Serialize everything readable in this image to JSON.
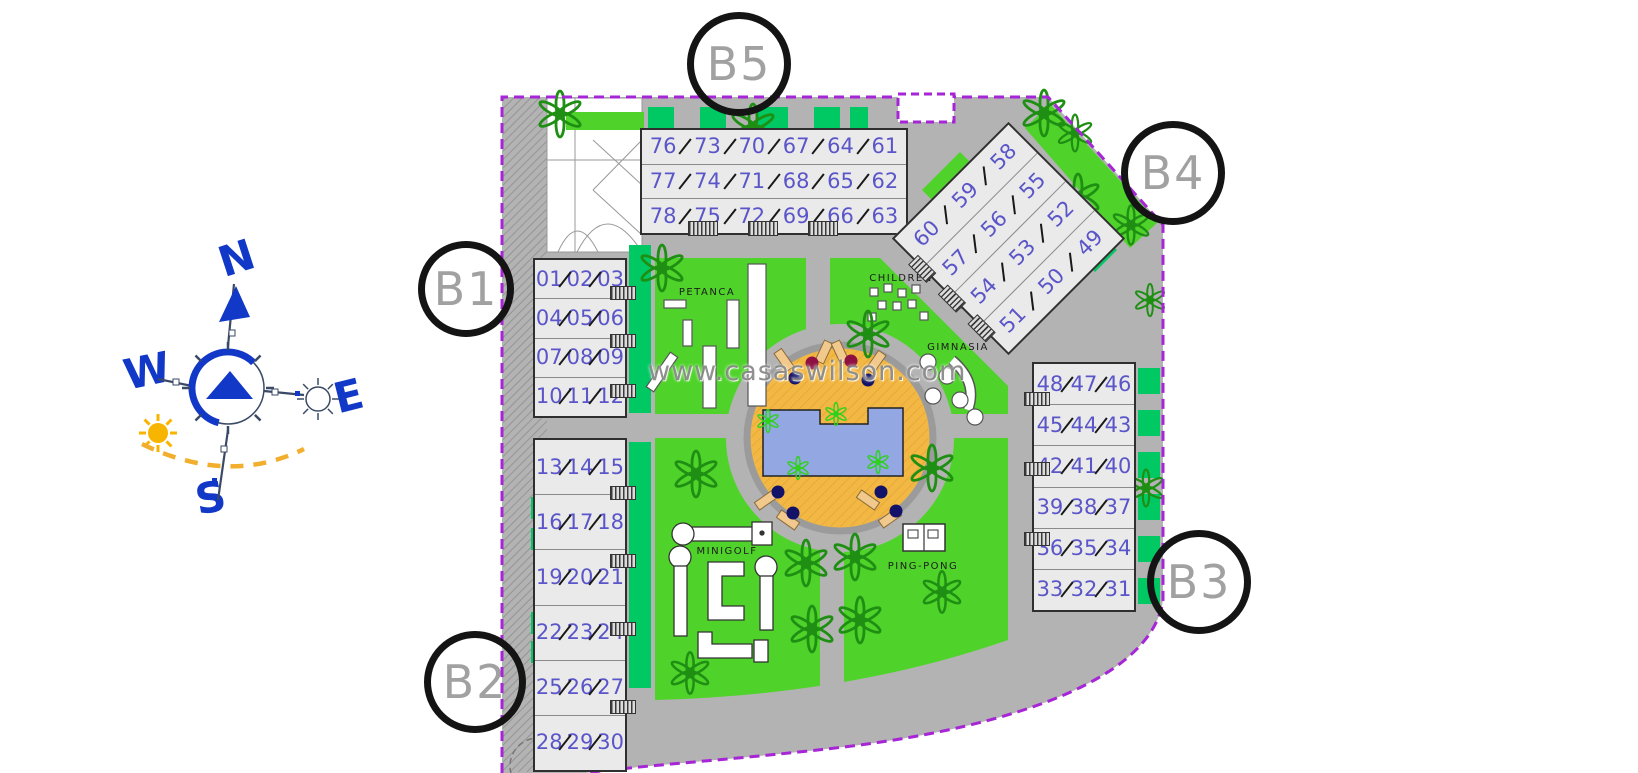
{
  "watermark": "www.casaswilson.com",
  "compass": {
    "n": "N",
    "e": "E",
    "s": "S",
    "w": "W"
  },
  "block_circles": [
    {
      "id": "b1",
      "label": "B1"
    },
    {
      "id": "b2",
      "label": "B2"
    },
    {
      "id": "b3",
      "label": "B3"
    },
    {
      "id": "b4",
      "label": "B4"
    },
    {
      "id": "b5",
      "label": "B5"
    }
  ],
  "amenities": {
    "petanca": "PETANCA",
    "children": "CHILDREN",
    "gimnasia": "GIMNASIA",
    "minigolf": "MINIGOLF",
    "ping_pong": "PING-PONG"
  },
  "buildings": [
    {
      "id": "top-terraces",
      "block": "B5",
      "rows": [
        [
          "76",
          "73",
          "70",
          "67",
          "64",
          "61"
        ],
        [
          "77",
          "74",
          "71",
          "68",
          "65",
          "62"
        ],
        [
          "78",
          "75",
          "72",
          "69",
          "66",
          "63"
        ]
      ]
    },
    {
      "id": "b4-terraces",
      "block": "B4",
      "rows": [
        [
          "60",
          "59",
          "58"
        ],
        [
          "57",
          "56",
          "55"
        ],
        [
          "54",
          "53",
          "52"
        ],
        [
          "51",
          "50",
          "49"
        ]
      ]
    },
    {
      "id": "b1-upper",
      "block": "B1",
      "rows": [
        [
          "01",
          "02",
          "03"
        ],
        [
          "04",
          "05",
          "06"
        ],
        [
          "07",
          "08",
          "09"
        ],
        [
          "10",
          "11",
          "12"
        ]
      ]
    },
    {
      "id": "b2-lower",
      "block": "B2",
      "rows": [
        [
          "13",
          "14",
          "15"
        ],
        [
          "16",
          "17",
          "18"
        ],
        [
          "19",
          "20",
          "21"
        ],
        [
          "22",
          "23",
          "24"
        ],
        [
          "25",
          "26",
          "27"
        ],
        [
          "28",
          "29",
          "30"
        ]
      ]
    },
    {
      "id": "b3-east",
      "block": "B3",
      "rows": [
        [
          "48",
          "47",
          "46"
        ],
        [
          "45",
          "44",
          "43"
        ],
        [
          "42",
          "41",
          "40"
        ],
        [
          "39",
          "38",
          "37"
        ],
        [
          "36",
          "35",
          "34"
        ],
        [
          "33",
          "32",
          "31"
        ]
      ]
    }
  ],
  "colors": {
    "lawn": "#4fd32a",
    "hedge": "#00c863",
    "road": "#b3b3b3",
    "boundary": "#a625d6",
    "unit_number": "#5a55c8",
    "deck": "#f3b843",
    "pool": "#93a7e2",
    "compass": "#1238c8",
    "sun": "#f7b500",
    "tree": "#1f8f14"
  }
}
